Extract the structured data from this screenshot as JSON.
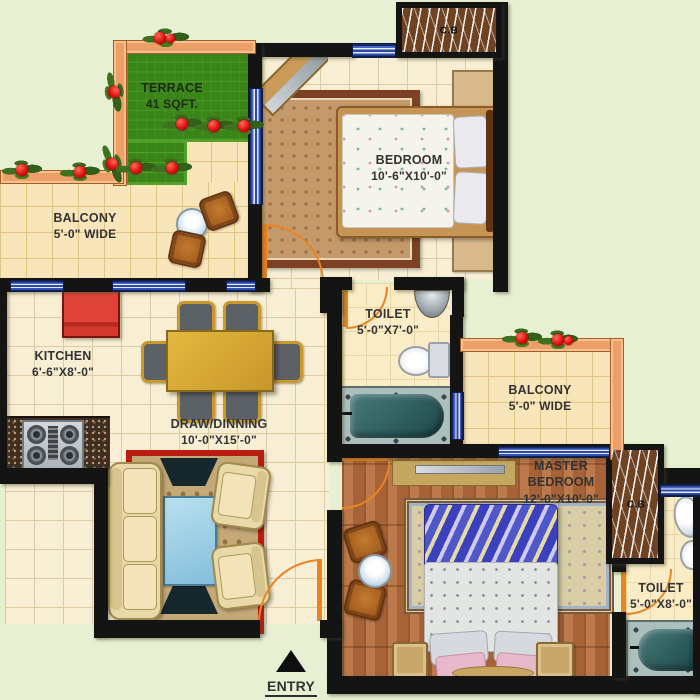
{
  "plan": {
    "rooms": [
      {
        "id": "terrace",
        "name": "TERRACE",
        "dims": "41 SQFT."
      },
      {
        "id": "balcony-left",
        "name": "BALCONY",
        "dims": "5'-0\" WIDE"
      },
      {
        "id": "bedroom",
        "name": "BEDROOM",
        "dims": "10'-6\"X10'-0\""
      },
      {
        "id": "kitchen",
        "name": "KITCHEN",
        "dims": "6'-6\"X8'-0\""
      },
      {
        "id": "toilet-1",
        "name": "TOILET",
        "dims": "5'-0\"X7'-0\""
      },
      {
        "id": "draw-dining",
        "name": "DRAW/DINNING",
        "dims": "10'-0\"X15'-0\""
      },
      {
        "id": "balcony-right",
        "name": "BALCONY",
        "dims": "5'-0\" WIDE"
      },
      {
        "id": "master-bedroom",
        "name": "MASTER BEDROOM",
        "dims": "12'-0\"X10'-0\""
      },
      {
        "id": "toilet-2",
        "name": "TOILET",
        "dims": "5'-0\"X8'-0\""
      }
    ],
    "cupboards": {
      "top": "C.B",
      "master": "C.B"
    },
    "entry": {
      "label": "ENTRY"
    },
    "colors": {
      "background": "#e7f0d2",
      "wall": "#141414",
      "terrace_green": "#55a02a",
      "railing_orange": "#ec9f66",
      "window_blue": "#2c4aa4",
      "door_orange": "#ea8423",
      "tile_floor": "#f7eed4",
      "wood_floor": "#b06a3e",
      "fridge_red": "#d23a2e",
      "rug_red_border": "#b91c10",
      "sofa_cream": "#ead9a8",
      "table_gold": "#d2a32f"
    }
  }
}
